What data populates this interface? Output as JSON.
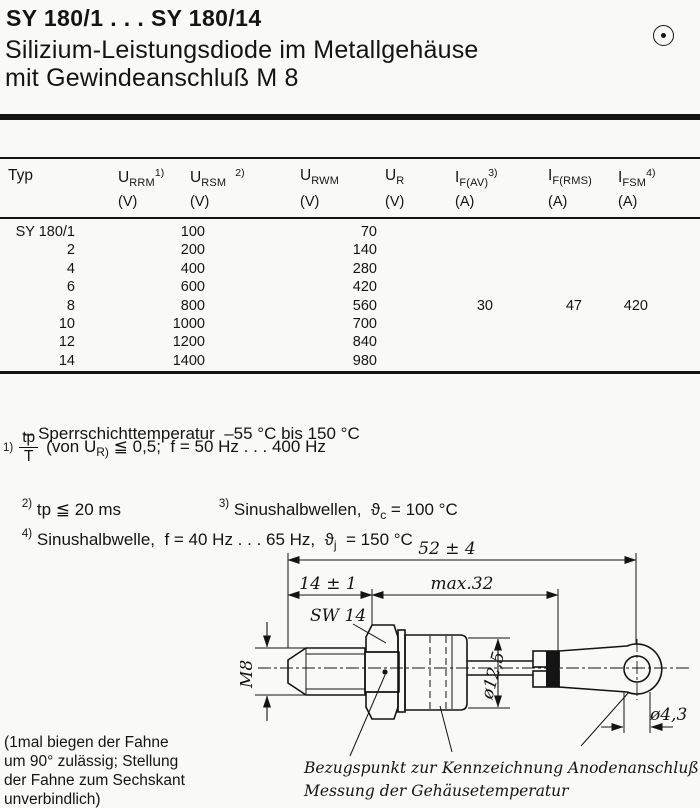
{
  "page": {
    "bg": "#f9f9f6",
    "ink": "#141414"
  },
  "header": {
    "title": "SY 180/1 . . . SY 180/14",
    "subtitle_line1": "Silizium-Leistungsdiode im Metallgehäuse",
    "subtitle_line2": "mit Gewindeanschluß M 8",
    "corner_icon": "circled-dot-icon"
  },
  "table": {
    "columns": [
      {
        "main": "Typ",
        "sub": "",
        "sup": "",
        "unit": ""
      },
      {
        "main": "U",
        "sub": "RRM",
        "sup": "1)",
        "unit": "(V)"
      },
      {
        "main": "U",
        "sub": "RSM",
        "sup": "2)",
        "unit": "(V)"
      },
      {
        "main": "U",
        "sub": "RWM",
        "sup": "",
        "unit": "(V)"
      },
      {
        "main": "U",
        "sub": "R",
        "sup": "",
        "unit": "(V)"
      },
      {
        "main": "I",
        "sub": "F(AV)",
        "sup": "3)",
        "unit": "(A)"
      },
      {
        "main": "I",
        "sub": "F(RMS)",
        "sup": "",
        "unit": "(A)"
      },
      {
        "main": "I",
        "sub": "FSM",
        "sup": "4)",
        "unit": "(A)"
      }
    ],
    "rows": [
      [
        "SY 180/1",
        "100",
        "",
        "70",
        "",
        "",
        "",
        ""
      ],
      [
        "2",
        "200",
        "",
        "140",
        "",
        "",
        "",
        ""
      ],
      [
        "4",
        "400",
        "",
        "280",
        "",
        "",
        "",
        ""
      ],
      [
        "6",
        "600",
        "",
        "420",
        "",
        "",
        "",
        ""
      ],
      [
        "8",
        "800",
        "",
        "560",
        "",
        "30",
        "47",
        "420"
      ],
      [
        "10",
        "1000",
        "",
        "700",
        "",
        "",
        "",
        ""
      ],
      [
        "12",
        "1200",
        "",
        "840",
        "",
        "",
        "",
        ""
      ],
      [
        "14",
        "1400",
        "",
        "980",
        "",
        "",
        "",
        ""
      ]
    ]
  },
  "notes": {
    "temp_range": "– Sperrschichttemperatur  –55 °C bis 150 °C",
    "fn1": {
      "marker": "1)",
      "frac_num": "tp",
      "frac_den": "T",
      "mid": "(von U",
      "sub": "R)",
      "rest": " ≦ 0,5;  f = 50 Hz . . . 400 Hz"
    },
    "fn2": {
      "marker": "2)",
      "text": "tp ≦ 20 ms"
    },
    "fn3": {
      "marker": "3)",
      "pre": "Sinushalbwellen,  ϑ",
      "sub": "c",
      "post": " = 100 °C"
    },
    "fn4": {
      "marker": "4)",
      "pre": "Sinushalbwelle,  f = 40 Hz . . . 65 Hz,  ϑ",
      "sub": "j",
      "post": "  = 150 °C"
    }
  },
  "drawing": {
    "dims": {
      "overall": "52 ± 4",
      "stud": "14 ± 1",
      "body": "max.32",
      "wrench": "SW 14",
      "thread": "M8",
      "body_dia": "ø12,5",
      "hole_dia": "ø4,3"
    },
    "captions": {
      "ref_point_1": "Bezugspunkt zur",
      "ref_point_2": "Messung der Gehäusetemperatur",
      "marking": "Kennzeichnung",
      "anode": "Anodenanschluß"
    },
    "side_note": "(1mal biegen der Fahne\num 90° zulässig; Stellung\nder Fahne zum Sechskant\nunverbindlich)"
  }
}
